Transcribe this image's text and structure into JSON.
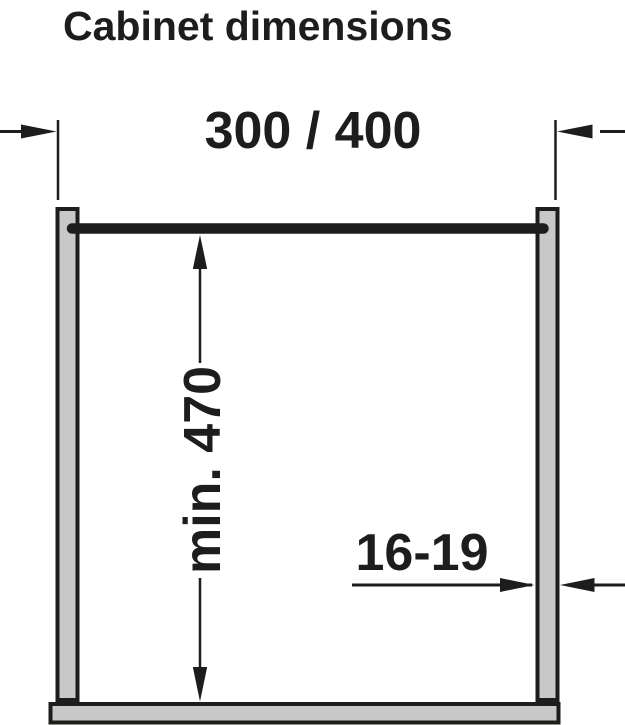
{
  "diagram": {
    "title": "Cabinet dimensions",
    "width_dimension": {
      "label": "300 / 400"
    },
    "height_dimension": {
      "label": "min. 470"
    },
    "panel_thickness_dimension": {
      "label": "16-19"
    }
  },
  "colors": {
    "line": "#1d1d1b",
    "panel_fill": "#c8c8c8",
    "background": "#ffffff"
  }
}
